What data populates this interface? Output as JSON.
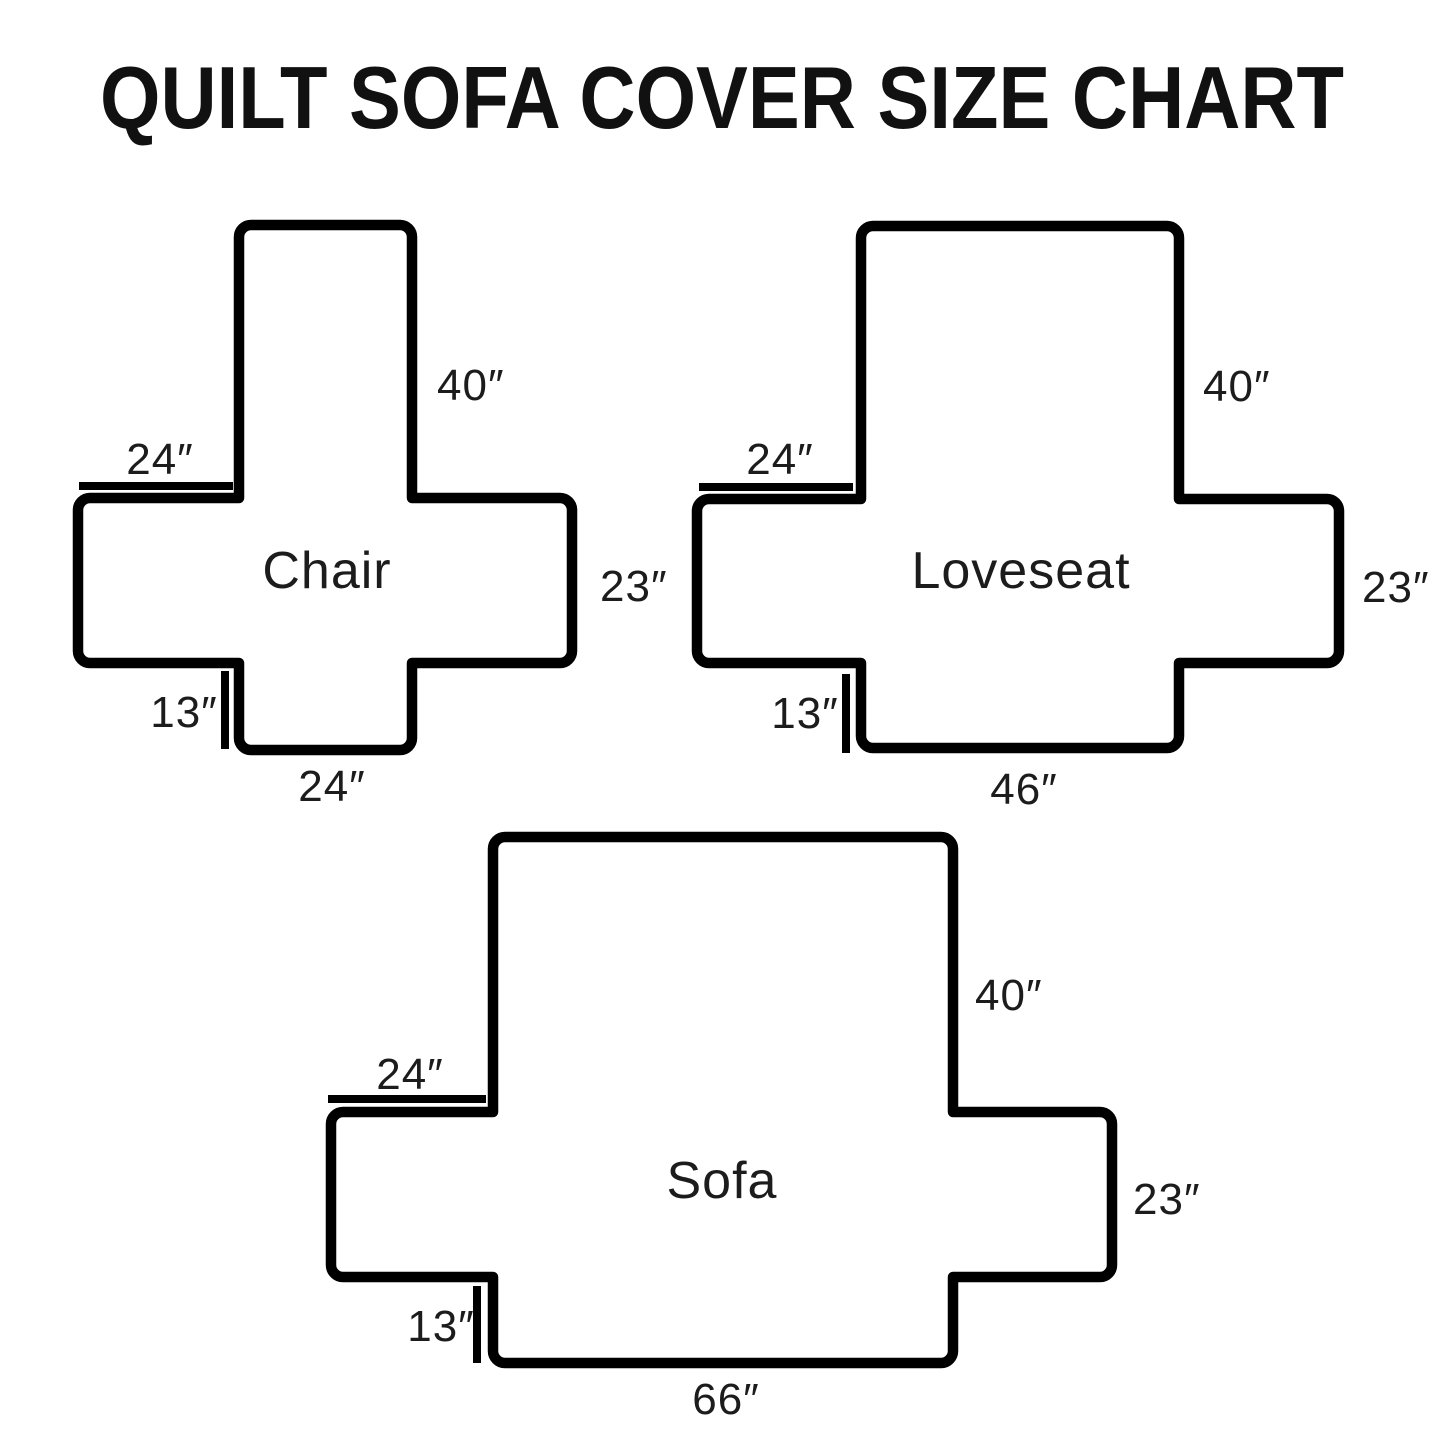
{
  "page": {
    "title": "QUILT SOFA COVER SIZE CHART",
    "background_color": "#ffffff",
    "line_color": "#000000",
    "text_color": "#1c1c1c"
  },
  "diagrams": [
    {
      "label": "Chair",
      "back_height": "40″",
      "arm_top_width": "24″",
      "arm_side_height": "23″",
      "front_flap_height": "13″",
      "bottom_width": "24″"
    },
    {
      "label": "Loveseat",
      "back_height": "40″",
      "arm_top_width": "24″",
      "arm_side_height": "23″",
      "front_flap_height": "13″",
      "bottom_width": "46″"
    },
    {
      "label": "Sofa",
      "back_height": "40″",
      "arm_top_width": "24″",
      "arm_side_height": "23″",
      "front_flap_height": "13″",
      "bottom_width": "66″"
    }
  ]
}
